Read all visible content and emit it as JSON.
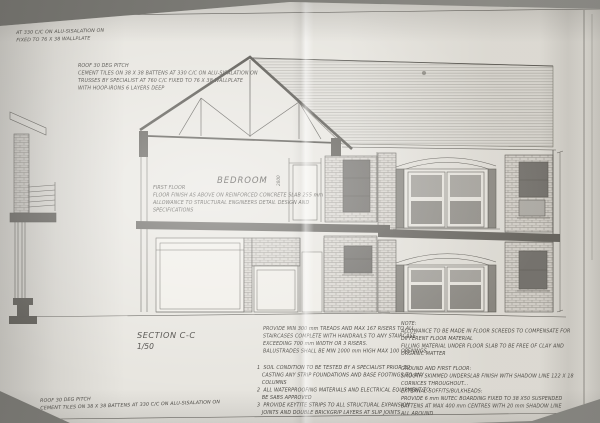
{
  "sheet": {
    "title": "SECTION C-C",
    "scale": "1/50",
    "room_label": "BEDROOM",
    "dim_bedroom_height": "2800"
  },
  "notes": {
    "eaves_note": [
      "AT 330 C/C ON ALU-SISALATION ON",
      "FIXED TO 76 X 38 WALLPLATE"
    ],
    "roof_note_top": [
      "ROOF 30 DEG PITCH",
      "CEMENT TILES ON 38 X 38 BATTENS AT 330 C/C ON ALU-SISALATION ON",
      "TRUSSES BY SPECIALIST AT 760 C/C FIXED TO 76 X 38 WALLPLATE",
      "WITH HOOP-IRONS 6 LAYERS DEEP"
    ],
    "first_floor_note": [
      "FIRST FLOOR",
      "FLOOR FINISH AS ABOVE ON REINFORCED CONCRETE SLAB 255 mm",
      "ALLOWANCE TO STRUCTURAL ENGINEERS DETAIL DESIGN AND",
      "SPECIFICATIONS"
    ],
    "stair_note": [
      "PROVIDE MIN 300 mm TREADS AND MAX 167 RISERS TO ALL",
      "STAIRCASES COMPLETE WITH HANDRAILS TO ANY STAIRCASE",
      "EXCEEDING 700 mm WIDTH OR 3 RISERS.",
      "BALUSTRADES SHALL BE MIN 1000 mm HIGH MAX 100 OPENINGS"
    ],
    "numbered_notes": [
      "1  SOIL CONDITION TO BE TESTED BY A SPECIALIST PRIOR TO",
      "   CASTING ANY STRIP FOUNDATIONS AND BASE FOOTINGS TO ANY",
      "   COLUMNS",
      "2  ALL WATERPROOFING MATERIALS AND ELECTRICAL EQUIPMENT TO",
      "   BE SABS APPROVED",
      "3  PROVIDE KEYTITE STRIPS TO ALL STRUCTURAL EXPANSION",
      "   JOINTS AND DOUBLE BRICKGRIP LAYERS AT SLIP JOINTS"
    ],
    "materials_note": [
      "NOTE:",
      "ALLOWANCE TO BE MADE IN FLOOR SCREEDS TO COMPENSATE FOR",
      "DIFFERENT FLOOR MATERIAL",
      "FILLING MATERIAL UNDER FLOOR SLAB TO BE FREE OF CLAY AND",
      "ORGANIC MATTER",
      "",
      "GROUND AND FIRST FLOOR:",
      "SMOOTH SKIMMED UNDERSLAB FINISH WITH SHADOW LINE 122 X 18",
      "CORNICES THROUGHOUT...",
      "EXTERNAL SOFFITS/BULKHEADS:",
      "PROVIDE 6 mm NUTEC BOARDING FIXED TO 38 X50 SUSPENDED",
      "BATTENS AT MAX 400 mm CENTRES WITH 20 mm SHADOW LINE",
      "ALL AROUND"
    ],
    "roof_note_bottom": [
      "ROOF 30 DEG PITCH",
      "CEMENT TILES ON 38 X 38 BATTENS AT 330 C/C ON ALU-SISALATION ON"
    ]
  },
  "colors": {
    "paper": "#e7e5df",
    "line": "#5c5a55",
    "slab": "#66645f",
    "window": "#75736f",
    "backdrop": "#7d7c77"
  }
}
